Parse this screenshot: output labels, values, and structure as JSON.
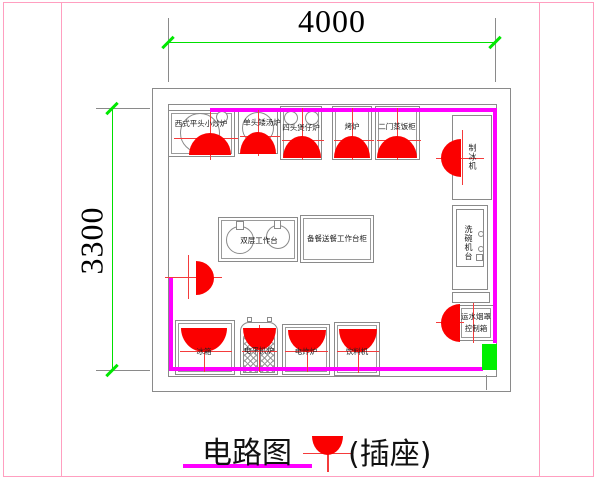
{
  "page": {
    "background": "#ffffff",
    "frame_color": "#ff9fc0"
  },
  "dimensions": {
    "top_label": "4000",
    "left_label": "3300"
  },
  "legend": {
    "title": "电路图",
    "symbol_label": "(插座)"
  },
  "colors": {
    "wall": "#ff00ff",
    "dimension_line": "#00e000",
    "outlet": "#fb0000",
    "door": "#00f000",
    "drawing_line": "#8a8a8a"
  },
  "equipment": {
    "top_row": [
      {
        "label": "西式平头小炒炉"
      },
      {
        "label": "单头矮汤炉"
      },
      {
        "label": "四头煲仔炉"
      },
      {
        "label": "烤炉"
      },
      {
        "label": "二门蒸饭柜"
      }
    ],
    "right_column": [
      {
        "label": "制冰机"
      },
      {
        "label": "洗碗机台"
      },
      {
        "label_line1": "运水烟罩",
        "label_line2": "控制箱"
      }
    ],
    "island": [
      {
        "label": "双层工作台"
      },
      {
        "label": "备餐送餐工作台柜"
      }
    ],
    "bottom_row": [
      {
        "label": "冰箱"
      },
      {
        "label": "电平扒炉"
      },
      {
        "label": "电炸炉"
      },
      {
        "label": "饮料机"
      }
    ]
  }
}
